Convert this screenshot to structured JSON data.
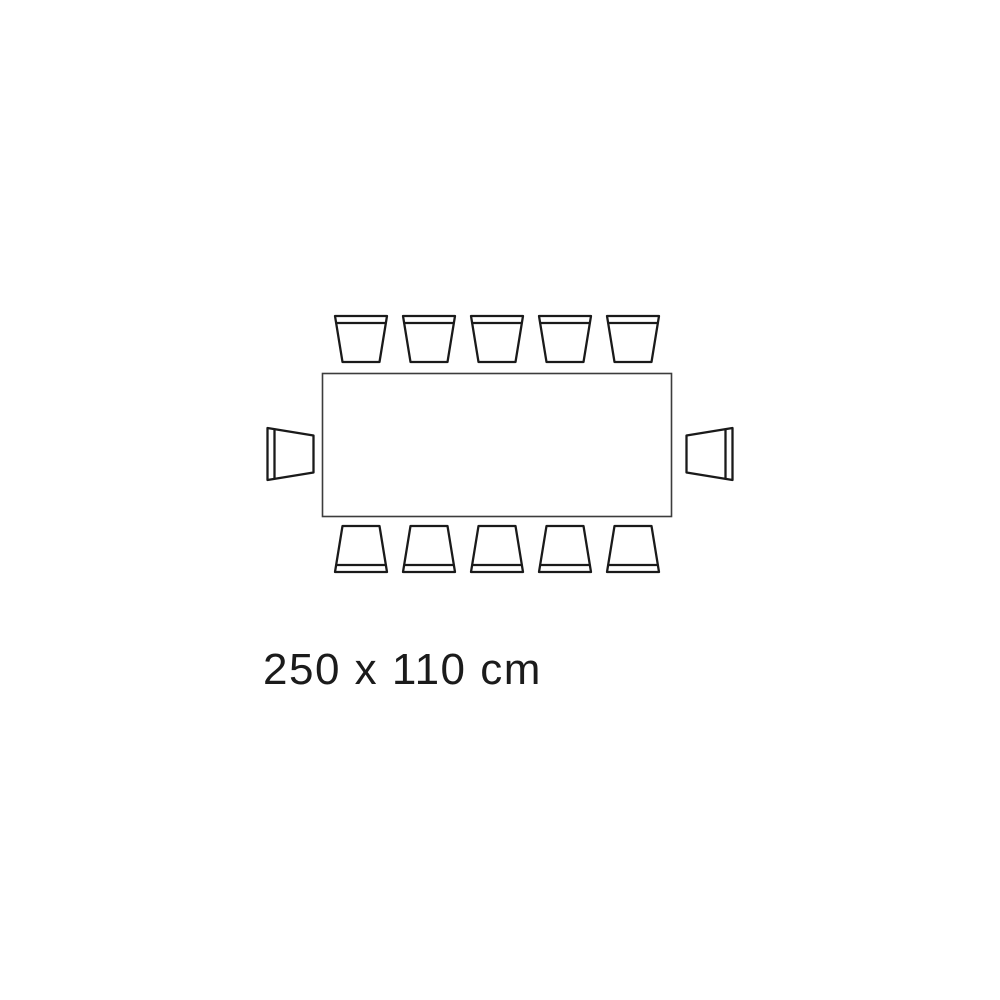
{
  "diagram": {
    "type": "table-seating-plan",
    "dimension_label": "250 x 110 cm",
    "table": {
      "shape": "rectangle",
      "width_cm": 250,
      "depth_cm": 110
    },
    "seating": {
      "total": 12,
      "top": 5,
      "bottom": 5,
      "left": 1,
      "right": 1
    },
    "colors": {
      "background": "#ffffff",
      "chair_outline": "#1a1a1a",
      "table_outline": "#3d3d3d",
      "label_text": "#1b1b1b"
    }
  }
}
